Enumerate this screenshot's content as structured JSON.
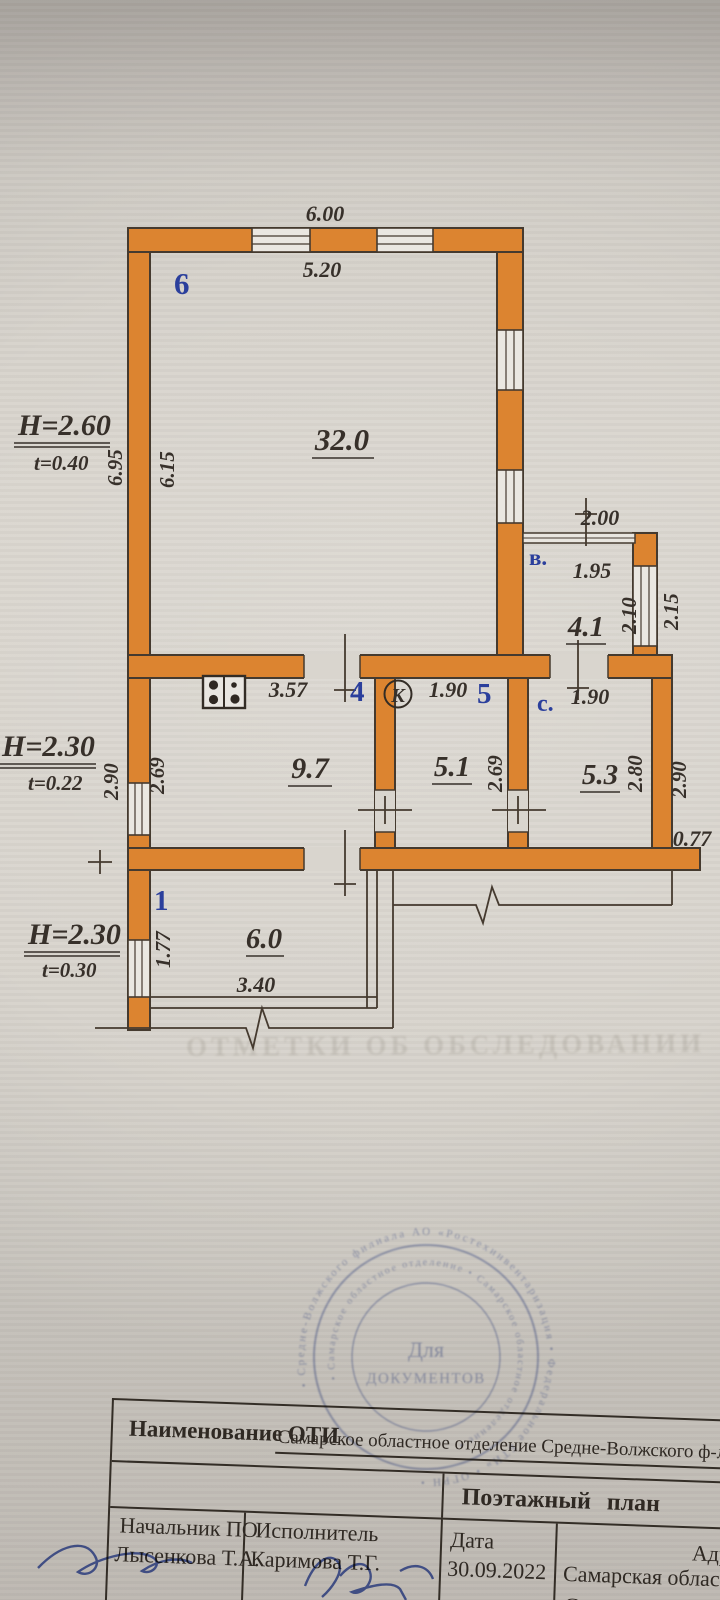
{
  "bleed_text": "ОТМЕТКИ ОБ ОБСЛЕДОВАНИИ",
  "colors": {
    "wall_orange": "#dc8430",
    "line_dark": "#453a2f",
    "ink": "#37302a",
    "room_number_blue": "#2b3f9c",
    "stamp_blue": "#7181bd",
    "signature_blue": "#3a52b0"
  },
  "plan": {
    "heights": [
      {
        "h": "Н=2.60",
        "t": "t=0.40"
      },
      {
        "h": "Н=2.30",
        "t": "t=0.22"
      },
      {
        "h": "Н=2.30",
        "t": "t=0.30"
      }
    ],
    "labels": {
      "top_out": "6.00",
      "top_in": "5.20",
      "r6_num": "6",
      "r6_area": "32.0",
      "left_out_6": "6.95",
      "left_in_6": "6.15",
      "h1": "Н=2.60",
      "t1": "t=0.40",
      "h2": "Н=2.30",
      "t2": "t=0.22",
      "h3": "Н=2.30",
      "t3": "t=0.30",
      "k_width": "3.57",
      "r4_num": "4",
      "r4_area": "9.7",
      "left_out_4": "2.90",
      "left_in_4": "2.69",
      "k_symbol": "К",
      "r5_w": "1.90",
      "r5_num": "5",
      "r5_area": "5.1",
      "r5_h": "2.69",
      "rc_name": "с.",
      "rc_w": "1.90",
      "rc_area": "5.3",
      "rc_in_h": "2.80",
      "rc_out_h": "2.90",
      "rb_name": "в.",
      "rb_out_w": "2.00",
      "rb_in_w": "1.95",
      "rb_area": "4.1",
      "rb_in_h": "2.10",
      "rb_out_h": "2.15",
      "ext": "0.77",
      "r1_num": "1",
      "r1_area": "6.0",
      "r1_h": "1.77",
      "r1_w": "3.40"
    }
  },
  "stamp": {
    "center_line1": "Для",
    "center_line2": "ДОКУМЕНТОВ",
    "ring_outer": "• Средне-Волжского филиала АО «Ростехинвентаризация • Федеральное БТИ» • ОГРН •",
    "ring_inner": "• Самарское областное отделение • Самарское областное отделение •"
  },
  "table": {
    "row1_label": "Наименование ОТИ",
    "row1_value": "Самарское областное отделение Средне-Волжского ф-ла А",
    "row2_title": "Поэтажный  план",
    "col1_role": "Начальник ПО",
    "col1_name": "Лысенкова Т.А.",
    "col2_role": "Исполнитель",
    "col2_name": "Каримова Т.Г.",
    "col3_role": "Дата",
    "col3_value": "30.09.2022",
    "col4_label": "Адрес",
    "col4_line1": "Самарская область",
    "col4_line2": "Советский р-н"
  }
}
